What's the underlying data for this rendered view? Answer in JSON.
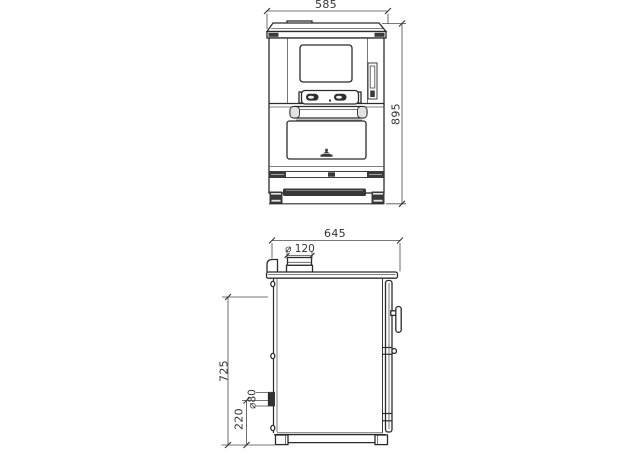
{
  "drawing": {
    "background": "#ffffff",
    "line_color": "#2b2b2b",
    "dim_line_color": "#4a4a4a",
    "dark_fill_color": "#3a3a3a",
    "dims": {
      "front_width": "585",
      "front_height": "895",
      "side_depth": "645",
      "flue_diameter": "⌀ 120",
      "left_height": "725",
      "rear_outlet_diameter": "⌀80",
      "rear_outlet_height": "220"
    }
  }
}
